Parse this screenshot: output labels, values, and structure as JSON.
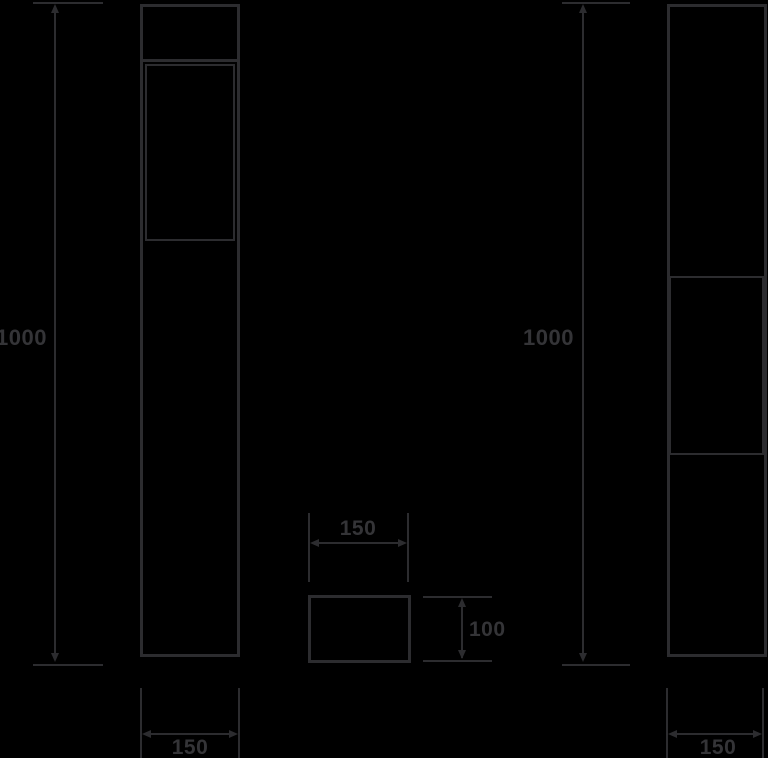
{
  "drawing": {
    "labels": {
      "left_height": "1000",
      "right_height": "1000",
      "left_base_width": "150",
      "right_base_width": "150",
      "plate_width": "150",
      "plate_height": "100"
    },
    "colors": {
      "background": "#000000",
      "line": "#2c2c2f",
      "text": "#343437"
    }
  }
}
